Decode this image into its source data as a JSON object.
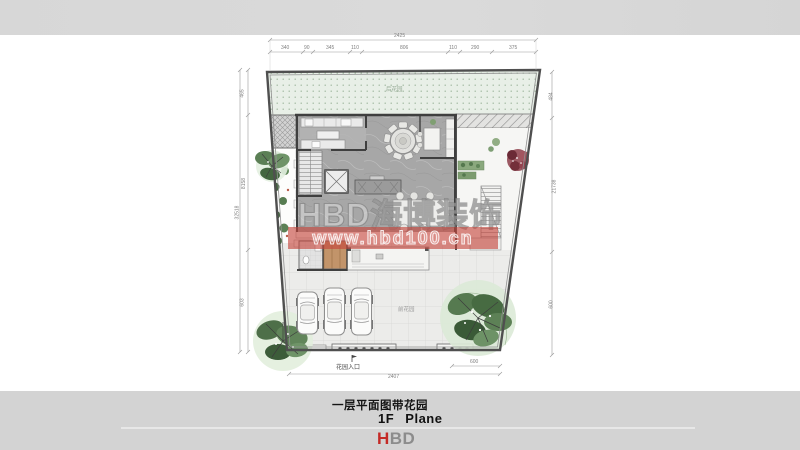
{
  "watermark": {
    "brand": "HBD海博装饰",
    "url": "www.hbd100.cn",
    "band_color": "#c5443a"
  },
  "plan": {
    "labels": {
      "back_garden": "后花园",
      "front_yard": "前花园",
      "entrance": "花园入口"
    },
    "dims": {
      "top_total": "2425",
      "top_segments": [
        "340",
        "90",
        "345",
        "110",
        "806",
        "110",
        "290",
        "375"
      ],
      "left_total": "32518",
      "left_segments": [
        "465",
        "8158",
        "603"
      ],
      "right_segments": [
        "484",
        "21738",
        "600"
      ],
      "bottom_total": "2407",
      "bottom_sub": "600"
    }
  },
  "footer": {
    "title_zh": "一层平面图带花园",
    "title_en": "1F Plane",
    "logo_h": "H",
    "logo_bd": "BD"
  },
  "colors": {
    "logo_red": "#c42a26",
    "logo_gray": "#8c8c8c",
    "watermark_red": "#c5443a",
    "garden_green": "#e8efe7"
  }
}
